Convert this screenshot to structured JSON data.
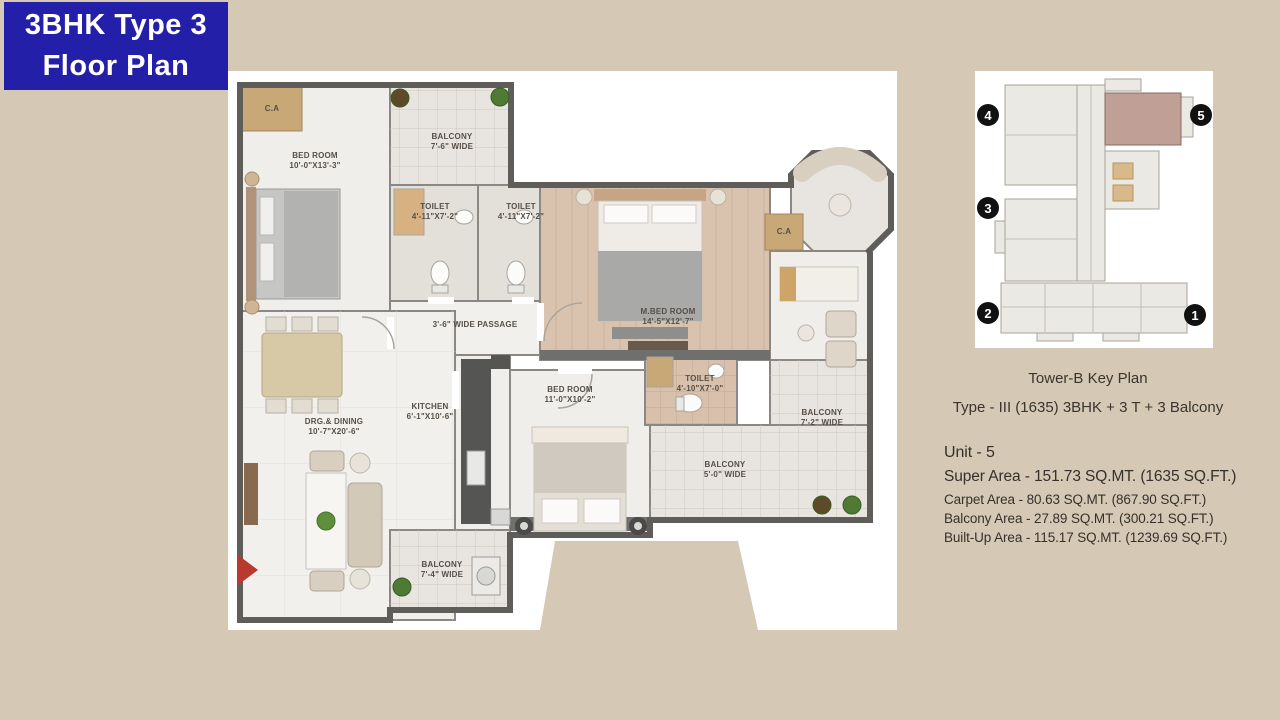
{
  "page": {
    "background": "#d5c9b6"
  },
  "title_badge": {
    "line1": "3BHK Type 3",
    "line2": "Floor Plan",
    "bg": "#241fa8",
    "fg": "#ffffff"
  },
  "floor_plan": {
    "rooms": [
      {
        "name": "C.A",
        "dims": ""
      },
      {
        "name": "BED ROOM",
        "dims": "10'-0\"X13'-3\""
      },
      {
        "name": "BALCONY",
        "dims": "7'-6\" WIDE"
      },
      {
        "name": "TOILET",
        "dims": "4'-11\"X7'-2\""
      },
      {
        "name": "TOILET",
        "dims": "4'-11\"X7'-2\""
      },
      {
        "name": "M.BED ROOM",
        "dims": "14'-5\"X12'-7\""
      },
      {
        "name": "C.A",
        "dims": ""
      },
      {
        "name": "3'-6\" WIDE PASSAGE",
        "dims": ""
      },
      {
        "name": "KITCHEN",
        "dims": "6'-1\"X10'-6\""
      },
      {
        "name": "DRG.& DINING",
        "dims": "10'-7\"X20'-6\""
      },
      {
        "name": "BED ROOM",
        "dims": "11'-0\"X10'-2\""
      },
      {
        "name": "TOILET",
        "dims": "4'-10\"X7'-0\""
      },
      {
        "name": "BALCONY",
        "dims": "7'-2\" WIDE"
      },
      {
        "name": "BALCONY",
        "dims": "5'-0\" WIDE"
      },
      {
        "name": "BALCONY",
        "dims": "7'-4\" WIDE"
      }
    ],
    "entry_marker_color": "#b8392e",
    "wall_color": "#5f5d5a",
    "wood_floor_color": "#d9c2ae"
  },
  "key_plan": {
    "caption": "Tower-B Key Plan",
    "subtitle": "Type - III (1635) 3BHK + 3 T + 3 Balcony",
    "markers": [
      "4",
      "5",
      "3",
      "2",
      "1"
    ],
    "highlight_color": "#c0a096",
    "marker_color": "#111111"
  },
  "unit_details": {
    "line1": "Unit - 5",
    "line2": "Super Area - 151.73 SQ.MT. (1635 SQ.FT.)",
    "line3": "Carpet Area - 80.63 SQ.MT. (867.90 SQ.FT.)",
    "line4": "Balcony Area - 27.89 SQ.MT. (300.21 SQ.FT.)",
    "line5": "Built-Up Area - 115.17 SQ.MT. (1239.69 SQ.FT.)"
  }
}
